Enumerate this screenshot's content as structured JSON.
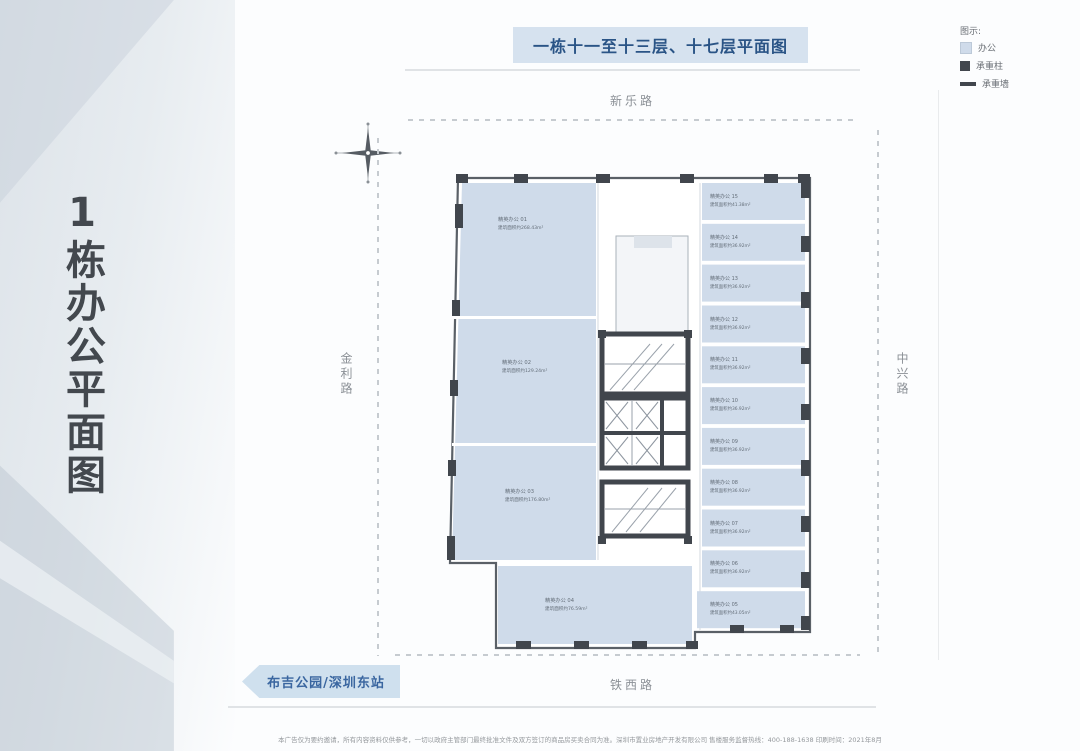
{
  "side_panel": {
    "vertical_title": "1栋办公平面图"
  },
  "header": {
    "title_badge": "一栋十一至十三层、十七层平面图"
  },
  "legend": {
    "title": "图示:",
    "items": [
      {
        "label": "办公"
      },
      {
        "label": "承重柱"
      },
      {
        "label": "承重墙"
      }
    ],
    "colors": {
      "office": "#cfdbea",
      "structure": "#41464d",
      "badge_bg": "#d6e2ef",
      "badge_text": "#2a5486"
    }
  },
  "roads": {
    "top": "新乐路",
    "left": "金利路",
    "right": "中兴路",
    "bottom": "铁西路"
  },
  "landmark": {
    "label": "布吉公园/深圳东站"
  },
  "floorplan": {
    "units_left": [
      {
        "name": "精英办公 01",
        "area": "建筑面积约268.43m²"
      },
      {
        "name": "精英办公 02",
        "area": "建筑面积约129.24m²"
      },
      {
        "name": "精英办公 03",
        "area": "建筑面积约176.80m²"
      }
    ],
    "units_right": [
      {
        "name": "精英办公 15",
        "area": "建筑面积约41.38m²"
      },
      {
        "name": "精英办公 14",
        "area": "建筑面积约36.92m²"
      },
      {
        "name": "精英办公 13",
        "area": "建筑面积约36.92m²"
      },
      {
        "name": "精英办公 12",
        "area": "建筑面积约36.92m²"
      },
      {
        "name": "精英办公 11",
        "area": "建筑面积约36.92m²"
      },
      {
        "name": "精英办公 10",
        "area": "建筑面积约36.92m²"
      },
      {
        "name": "精英办公 09",
        "area": "建筑面积约36.92m²"
      },
      {
        "name": "精英办公 08",
        "area": "建筑面积约36.92m²"
      },
      {
        "name": "精英办公 07",
        "area": "建筑面积约36.92m²"
      },
      {
        "name": "精英办公 06",
        "area": "建筑面积约36.92m²"
      },
      {
        "name": "精英办公 05",
        "area": "建筑面积约43.05m²"
      }
    ],
    "unit_bottom": {
      "name": "精英办公 04",
      "area": "建筑面积约76.59m²"
    }
  },
  "footer": {
    "disclaimer": "本广告仅为要约邀请，所有内容资料仅供参考，一切以政府主管部门最终批准文件及双方签订的商品房买卖合同为准。深圳市置业房地产开发有限公司  售楼服务监督热线：400-188-1638  印刷时间：2021年8月"
  }
}
